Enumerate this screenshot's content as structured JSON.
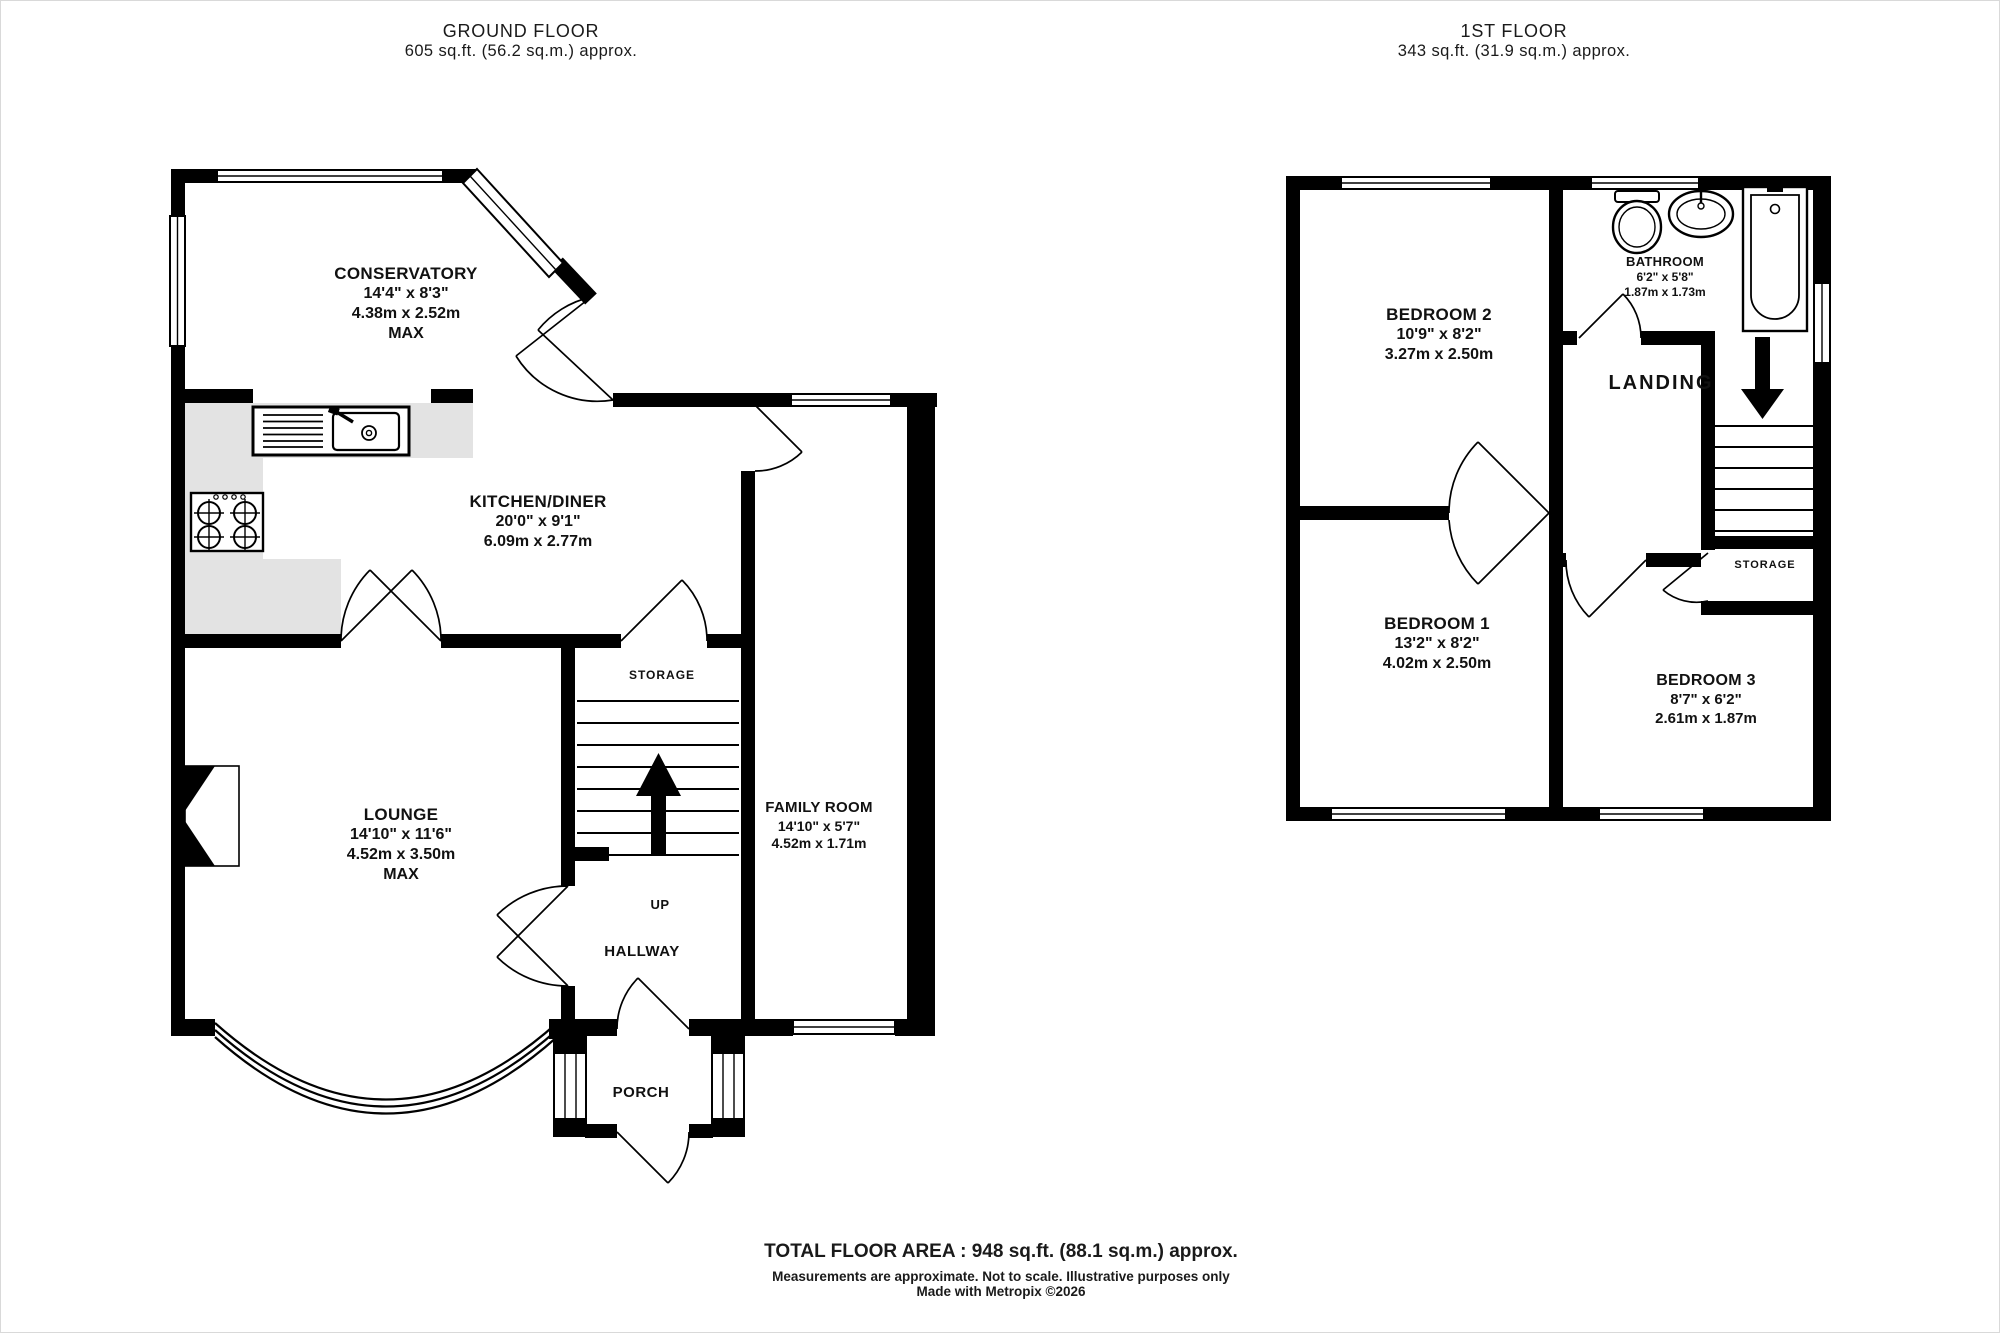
{
  "colors": {
    "wall": "#000000",
    "counter": "#e3e3e3",
    "background": "#ffffff",
    "text": "#111111"
  },
  "header": {
    "ground_floor_title": "GROUND FLOOR",
    "ground_floor_area": "605 sq.ft. (56.2 sq.m.) approx.",
    "first_floor_title": "1ST FLOOR",
    "first_floor_area": "343 sq.ft. (31.9 sq.m.) approx."
  },
  "ground_floor": {
    "conservatory": {
      "name": "CONSERVATORY",
      "imperial": "14'4\" x 8'3\"",
      "metric": "4.38m x 2.52m",
      "note": "MAX"
    },
    "kitchen_diner": {
      "name": "KITCHEN/DINER",
      "imperial": "20'0\" x 9'1\"",
      "metric": "6.09m x 2.77m"
    },
    "lounge": {
      "name": "LOUNGE",
      "imperial": "14'10\" x 11'6\"",
      "metric": "4.52m x 3.50m",
      "note": "MAX"
    },
    "family_room": {
      "name": "FAMILY ROOM",
      "imperial": "14'10\" x 5'7\"",
      "metric": "4.52m x 1.71m"
    },
    "storage": {
      "name": "STORAGE"
    },
    "hallway": {
      "name": "HALLWAY"
    },
    "porch": {
      "name": "PORCH"
    },
    "stairs": {
      "label": "UP"
    }
  },
  "first_floor": {
    "bedroom_2": {
      "name": "BEDROOM 2",
      "imperial": "10'9\" x 8'2\"",
      "metric": "3.27m x 2.50m"
    },
    "bedroom_1": {
      "name": "BEDROOM 1",
      "imperial": "13'2\" x 8'2\"",
      "metric": "4.02m x 2.50m"
    },
    "bedroom_3": {
      "name": "BEDROOM 3",
      "imperial": "8'7\" x 6'2\"",
      "metric": "2.61m x 1.87m"
    },
    "bathroom": {
      "name": "BATHROOM",
      "imperial": "6'2\" x 5'8\"",
      "metric": "1.87m x 1.73m"
    },
    "landing": {
      "name": "LANDING"
    },
    "storage": {
      "name": "STORAGE"
    }
  },
  "footer": {
    "total_area": "TOTAL FLOOR AREA : 948 sq.ft. (88.1 sq.m.) approx.",
    "disclaimer": "Measurements are approximate.  Not to scale.  Illustrative purposes only",
    "credit": "Made with Metropix ©2026"
  }
}
